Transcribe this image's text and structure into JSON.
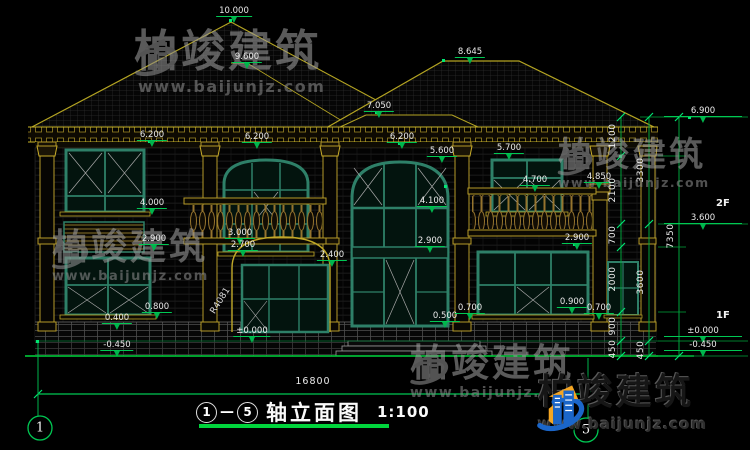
{
  "colors": {
    "cad_green": "#00c853",
    "cad_yellow": "#c0a828",
    "window_teal": "#2e8068",
    "logo_blue": "#1b66c9",
    "logo_orange": "#f5a623",
    "text_white": "#ebebeb"
  },
  "watermark": {
    "brand": "柏竣建筑",
    "url": "www.baijunjz.com"
  },
  "title_block": {
    "bubble_start": "1",
    "dash": "—",
    "bubble_end": "5",
    "text": "轴立面图",
    "scale": "1:100"
  },
  "dims": {
    "overall": "16800"
  },
  "floor_tags": [
    {
      "l": "2F",
      "x": 716,
      "y": 198
    },
    {
      "l": "1F",
      "x": 716,
      "y": 310
    }
  ],
  "axis_bubbles": [
    {
      "l": "1",
      "x": 40,
      "y": 428
    },
    {
      "l": "5",
      "x": 586,
      "y": 430
    }
  ],
  "rotated_labels": [
    {
      "l": "R4081",
      "x": 206,
      "y": 296,
      "deg": -58
    }
  ],
  "vdims": [
    {
      "x": 621,
      "items": [
        {
          "l": "1200",
          "y": 136
        },
        {
          "l": "2100",
          "y": 190
        },
        {
          "l": "700",
          "y": 235
        },
        {
          "l": "2000",
          "y": 279
        },
        {
          "l": "900",
          "y": 326
        },
        {
          "l": "450",
          "y": 349
        }
      ]
    },
    {
      "x": 649,
      "items": [
        {
          "l": "3300",
          "y": 170
        },
        {
          "l": "3600",
          "y": 282
        },
        {
          "l": "450",
          "y": 350
        }
      ]
    },
    {
      "x": 679,
      "items": [
        {
          "l": "7350",
          "y": 236
        }
      ]
    }
  ],
  "markers": [
    {
      "l": "10.000",
      "x": 234,
      "y": 17
    },
    {
      "l": "9.600",
      "x": 247,
      "y": 63
    },
    {
      "l": "8.645",
      "x": 470,
      "y": 58
    },
    {
      "l": "7.050",
      "x": 379,
      "y": 112
    },
    {
      "l": "6.200",
      "x": 152,
      "y": 141
    },
    {
      "l": "6.200",
      "x": 257,
      "y": 143
    },
    {
      "l": "6.200",
      "x": 402,
      "y": 143
    },
    {
      "l": "6.900",
      "x": 664,
      "y": 117,
      "r": true
    },
    {
      "l": "5.600",
      "x": 442,
      "y": 157
    },
    {
      "l": "5.700",
      "x": 509,
      "y": 154
    },
    {
      "l": "4.700",
      "x": 535,
      "y": 186
    },
    {
      "l": "4.850",
      "x": 599,
      "y": 183
    },
    {
      "l": "4.000",
      "x": 152,
      "y": 209
    },
    {
      "l": "4.100",
      "x": 432,
      "y": 207
    },
    {
      "l": "3.600",
      "x": 664,
      "y": 224,
      "r": true
    },
    {
      "l": "3.000",
      "x": 240,
      "y": 239
    },
    {
      "l": "2.700",
      "x": 243,
      "y": 251
    },
    {
      "l": "2.400",
      "x": 332,
      "y": 261
    },
    {
      "l": "2.900",
      "x": 154,
      "y": 245
    },
    {
      "l": "2.900",
      "x": 430,
      "y": 247
    },
    {
      "l": "2.900",
      "x": 577,
      "y": 244
    },
    {
      "l": "0.800",
      "x": 157,
      "y": 313
    },
    {
      "l": "0.400",
      "x": 117,
      "y": 324
    },
    {
      "l": "0.500",
      "x": 445,
      "y": 322
    },
    {
      "l": "0.700",
      "x": 470,
      "y": 314
    },
    {
      "l": "0.900",
      "x": 572,
      "y": 308
    },
    {
      "l": "0.700",
      "x": 599,
      "y": 314
    },
    {
      "l": "±0.000",
      "x": 252,
      "y": 337
    },
    {
      "l": "±0.000",
      "x": 664,
      "y": 337,
      "r": true
    },
    {
      "l": "-0.450",
      "x": 117,
      "y": 351
    },
    {
      "l": "-0.450",
      "x": 664,
      "y": 351,
      "r": true
    }
  ]
}
